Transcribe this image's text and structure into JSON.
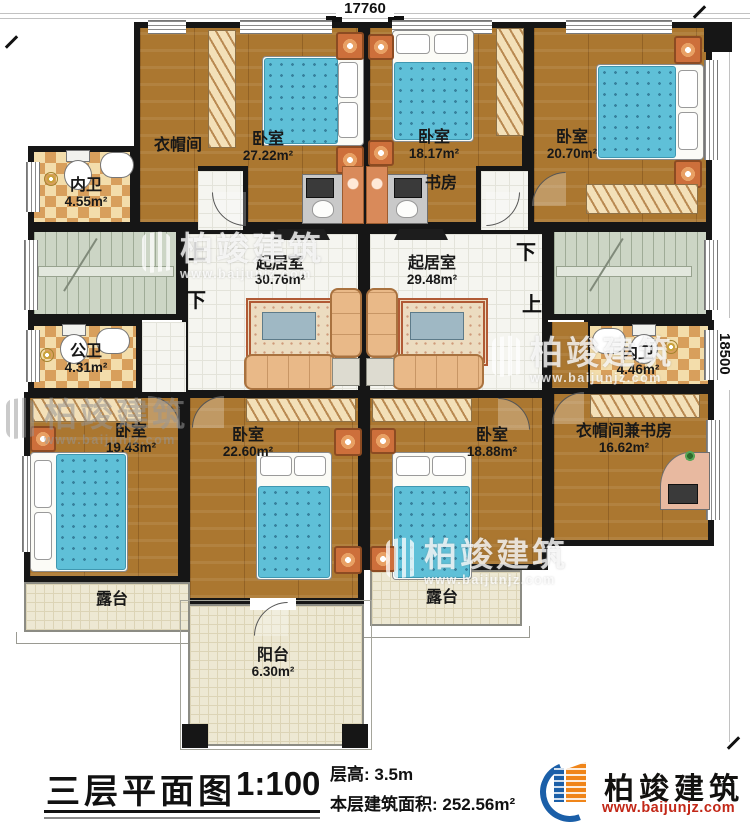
{
  "title": {
    "name": "三层平面图",
    "scale": "1:100",
    "floor_height": "层高: 3.5m",
    "floor_area": "本层建筑面积: 252.56m²"
  },
  "dims": {
    "top": "17760",
    "right": "18500"
  },
  "brand": {
    "name": "柏竣建筑",
    "url": "www.baijunjz.com"
  },
  "watermark": {
    "name": "柏竣建筑",
    "url": "www.baijunjz.com"
  },
  "stairs": {
    "left_up": "上",
    "left_down": "下",
    "right_down": "下",
    "right_up": "上"
  },
  "rooms": {
    "closet1": {
      "label": "衣帽间"
    },
    "bedroom1": {
      "label": "卧室",
      "area": "27.22m²"
    },
    "bath1": {
      "label": "内卫",
      "area": "4.55m²"
    },
    "bedroom2": {
      "label": "卧室",
      "area": "18.17m²"
    },
    "study": {
      "label": "书房"
    },
    "bedroom3": {
      "label": "卧室",
      "area": "20.70m²"
    },
    "living1": {
      "label": "起居室",
      "area": "30.76m²"
    },
    "living2": {
      "label": "起居室",
      "area": "29.48m²"
    },
    "bath2": {
      "label": "公卫",
      "area": "4.31m²"
    },
    "bath3": {
      "label": "内卫",
      "area": "4.46m²"
    },
    "bedroom4": {
      "label": "卧室",
      "area": "19.43m²"
    },
    "bedroom5": {
      "label": "卧室",
      "area": "22.60m²"
    },
    "bedroom6": {
      "label": "卧室",
      "area": "18.88m²"
    },
    "closetStudy": {
      "label": "衣帽间兼书房",
      "area": "16.62m²"
    },
    "terrace1": {
      "label": "露台"
    },
    "terrace2": {
      "label": "露台"
    },
    "balcony": {
      "label": "阳台",
      "area": "6.30m²"
    }
  }
}
